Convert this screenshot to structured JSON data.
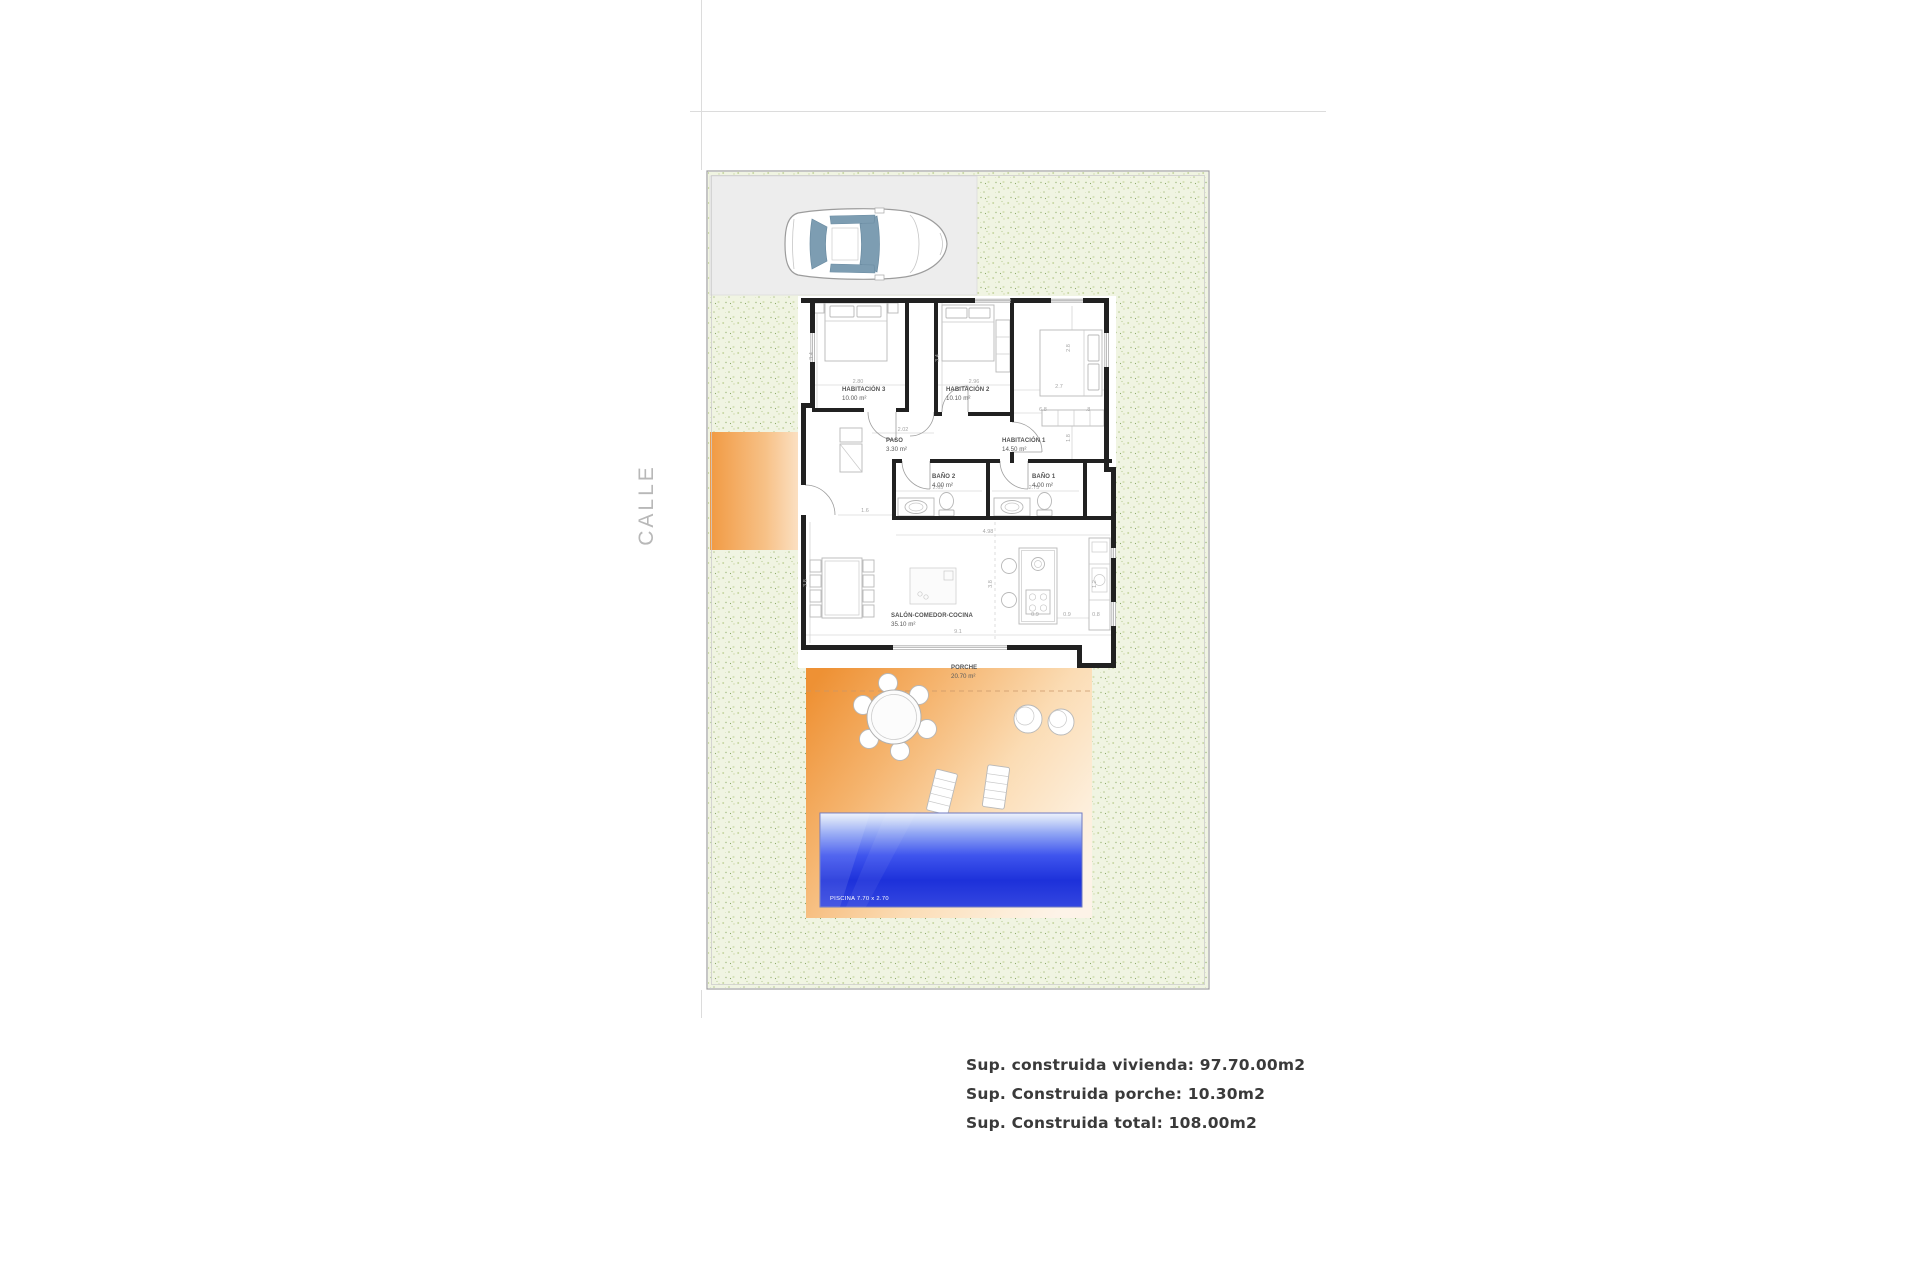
{
  "street_label": "CALLE",
  "plan": {
    "rooms": [
      {
        "name": "HABITACIÓN 3",
        "area": "10.00 m²"
      },
      {
        "name": "HABITACIÓN 2",
        "area": "10.10 m²"
      },
      {
        "name": "HABITACIÓN 1",
        "area": "14.50 m²"
      },
      {
        "name": "PASO",
        "area": "3.30 m²"
      },
      {
        "name": "BAÑO 2",
        "area": "4.00 m²"
      },
      {
        "name": "BAÑO 1",
        "area": "4.00 m²"
      },
      {
        "name": "SALÓN-COMEDOR-COCINA",
        "area": "35.10 m²"
      },
      {
        "name": "PORCHE",
        "area": "20.70 m²"
      }
    ],
    "pool_label": "PISCINA 7.70 x 2.70",
    "dims": {
      "hab3_w": "2.80",
      "hab3_h": "3.4",
      "hab2_w": "2.96",
      "hab2_h": "3.4",
      "hab1_w": "2.7",
      "hab1_h": "2.8",
      "hab1_inner": "6.8",
      "hab1_jog": ".8",
      "hab1_depth": "1.8",
      "paso_w": "2.02",
      "bano2_w": "2.65",
      "bano1_w": "2.75",
      "entry_w": "1.6",
      "salon_w": "4.98",
      "salon_h": "3.8",
      "salon_mid": "3.8",
      "salon_total": "9.1",
      "porch_w": "6.2",
      "k1": "0.9",
      "k2": "0.9",
      "k3": "0.8",
      "k4": "1.2"
    }
  },
  "summary": [
    "Sup. construida vivienda: 97.70.00m2",
    "Sup. Construida porche: 10.30m2",
    "Sup. Construida total: 108.00m2"
  ],
  "colors": {
    "accent_orange": "#f0913b",
    "pool_blue": "#2338df",
    "garden_green": "#eef3dd",
    "driveway_gray": "#ededed",
    "wall": "#212121"
  }
}
